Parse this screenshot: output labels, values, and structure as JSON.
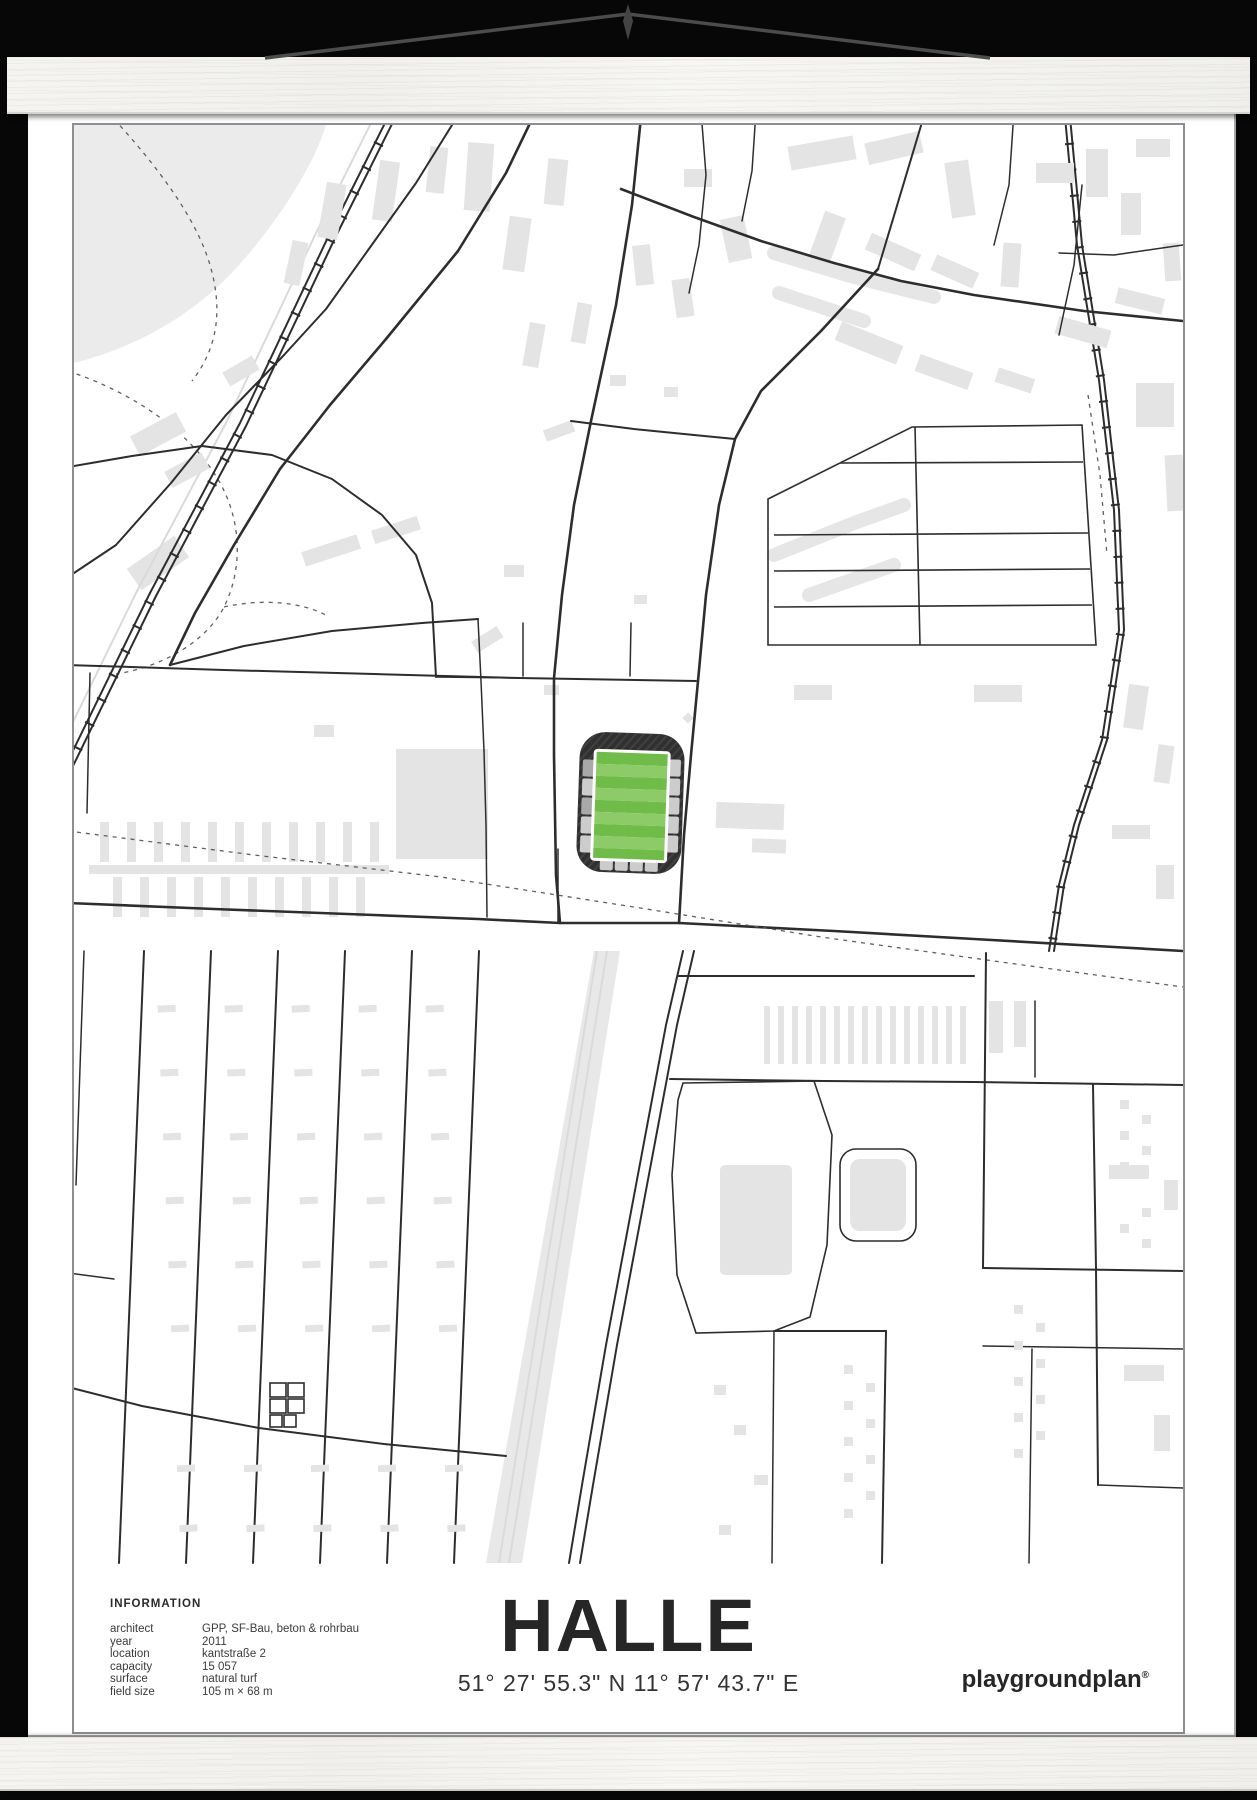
{
  "poster": {
    "title": "HALLE",
    "coordinates": "51° 27' 55.3\" N 11° 57' 43.7\" E",
    "brand": "playgroundplan",
    "brand_mark": "®"
  },
  "information": {
    "heading": "INFORMATION",
    "rows": [
      {
        "label": "architect",
        "value": "GPP, SF-Bau, beton & rohrbau"
      },
      {
        "label": "year",
        "value": "2011"
      },
      {
        "label": "location",
        "value": "kantstraße 2"
      },
      {
        "label": "capacity",
        "value": "15 057"
      },
      {
        "label": "surface",
        "value": "natural turf"
      },
      {
        "label": "field size",
        "value": "105 m × 68 m"
      }
    ]
  },
  "colors": {
    "background": "#070707",
    "wood": "#f6f5f2",
    "paper": "#ffffff",
    "frame_border": "#8f8f8f",
    "road": "#2d2d2d",
    "building": "#e4e4e4",
    "stadium_ring": "#303030",
    "stand": "#cccccc",
    "pitch_light": "#8ccb67",
    "pitch_dark": "#6fbd48",
    "string": "#4c4c4c"
  }
}
